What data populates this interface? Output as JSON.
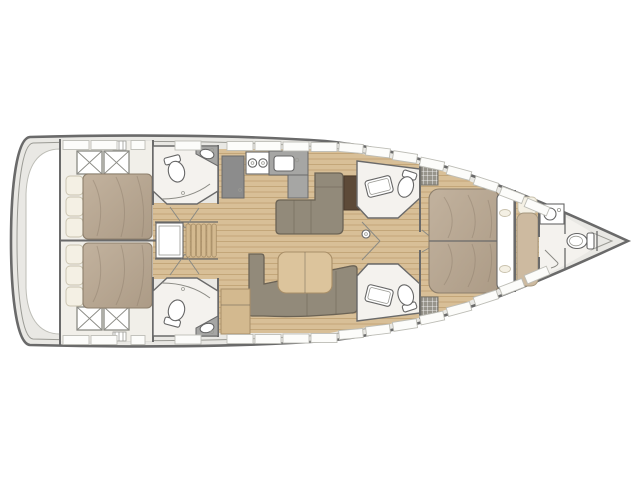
{
  "title": "Sailing yacht interior deck layout plan, bow pointing right",
  "boat": {
    "orientation": "bow-right",
    "regions": [
      {
        "id": "stern-platform"
      },
      {
        "id": "aft-cabin-port"
      },
      {
        "id": "aft-cabin-starboard"
      },
      {
        "id": "aft-head-port"
      },
      {
        "id": "aft-head-starboard"
      },
      {
        "id": "companionway-stairs"
      },
      {
        "id": "engine-compartment"
      },
      {
        "id": "galley"
      },
      {
        "id": "salon-dinette"
      },
      {
        "id": "salon-sofa"
      },
      {
        "id": "mid-head-port"
      },
      {
        "id": "mid-head-starboard"
      },
      {
        "id": "owner-cabin"
      },
      {
        "id": "forward-head"
      },
      {
        "id": "anchor-locker"
      }
    ]
  },
  "colors": {
    "background": "#ffffff",
    "hull_outline": "#6a6a6a",
    "hull_inner_line": "#9a9a94",
    "deck": "#e9e8e4",
    "locker_fill": "#fcfcfa",
    "locker_stroke": "#bdbdb6",
    "wood_base": "#d8bf97",
    "wood_line": "#c3a679",
    "wood_dark": "#a98f68",
    "furniture_wood": "#d3b98f",
    "table_wood": "#dcc49c",
    "mattress_stroke": "#8d7f6c",
    "pillow": "#f4f0e4",
    "pillow_stroke": "#c9c2ae",
    "sofa": "#928a7a",
    "sofa_stroke": "#6b6355",
    "counter": "#a6a6a4",
    "appliance": "#8c8c8c",
    "chart_table": "#5d4a38",
    "room_floor": "#f4f2ee",
    "fixture": "#ffffff",
    "fixture_stroke": "#666666",
    "wall": "#6a6a6a",
    "cabin_floor": "#f1efe9",
    "grid_bg": "#97948b",
    "bench": "#cdbaa0",
    "bench_stroke": "#a5977e",
    "door_line": "#8a8a84",
    "mattress_light": "#c2b29e",
    "mattress_dark": "#ac9b86"
  }
}
